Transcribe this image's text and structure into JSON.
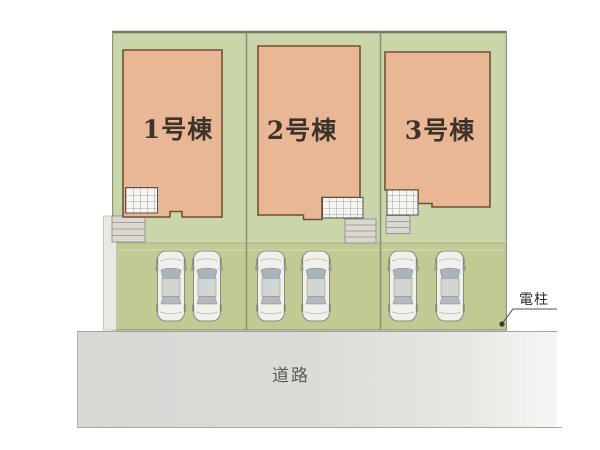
{
  "plan": {
    "title": "site-layout-plan",
    "lots": [
      {
        "id": 1,
        "label": "1号棟",
        "parking_spaces": 2
      },
      {
        "id": 2,
        "label": "2号棟",
        "parking_spaces": 2
      },
      {
        "id": 3,
        "label": "3号棟",
        "parking_spaces": 2
      }
    ],
    "road_label": "道路",
    "utility_pole_label": "電柱",
    "colors": {
      "lot_green": "#cbd5aa",
      "parking_green": "#c0ca92",
      "building_fill": "#e9b795",
      "building_outline": "#6f5136",
      "boundary_line": "#8e957a",
      "road_gray": "#d8d7d4",
      "concrete_gray": "#dad8d0",
      "porch_white": "#f6f5f1"
    }
  }
}
